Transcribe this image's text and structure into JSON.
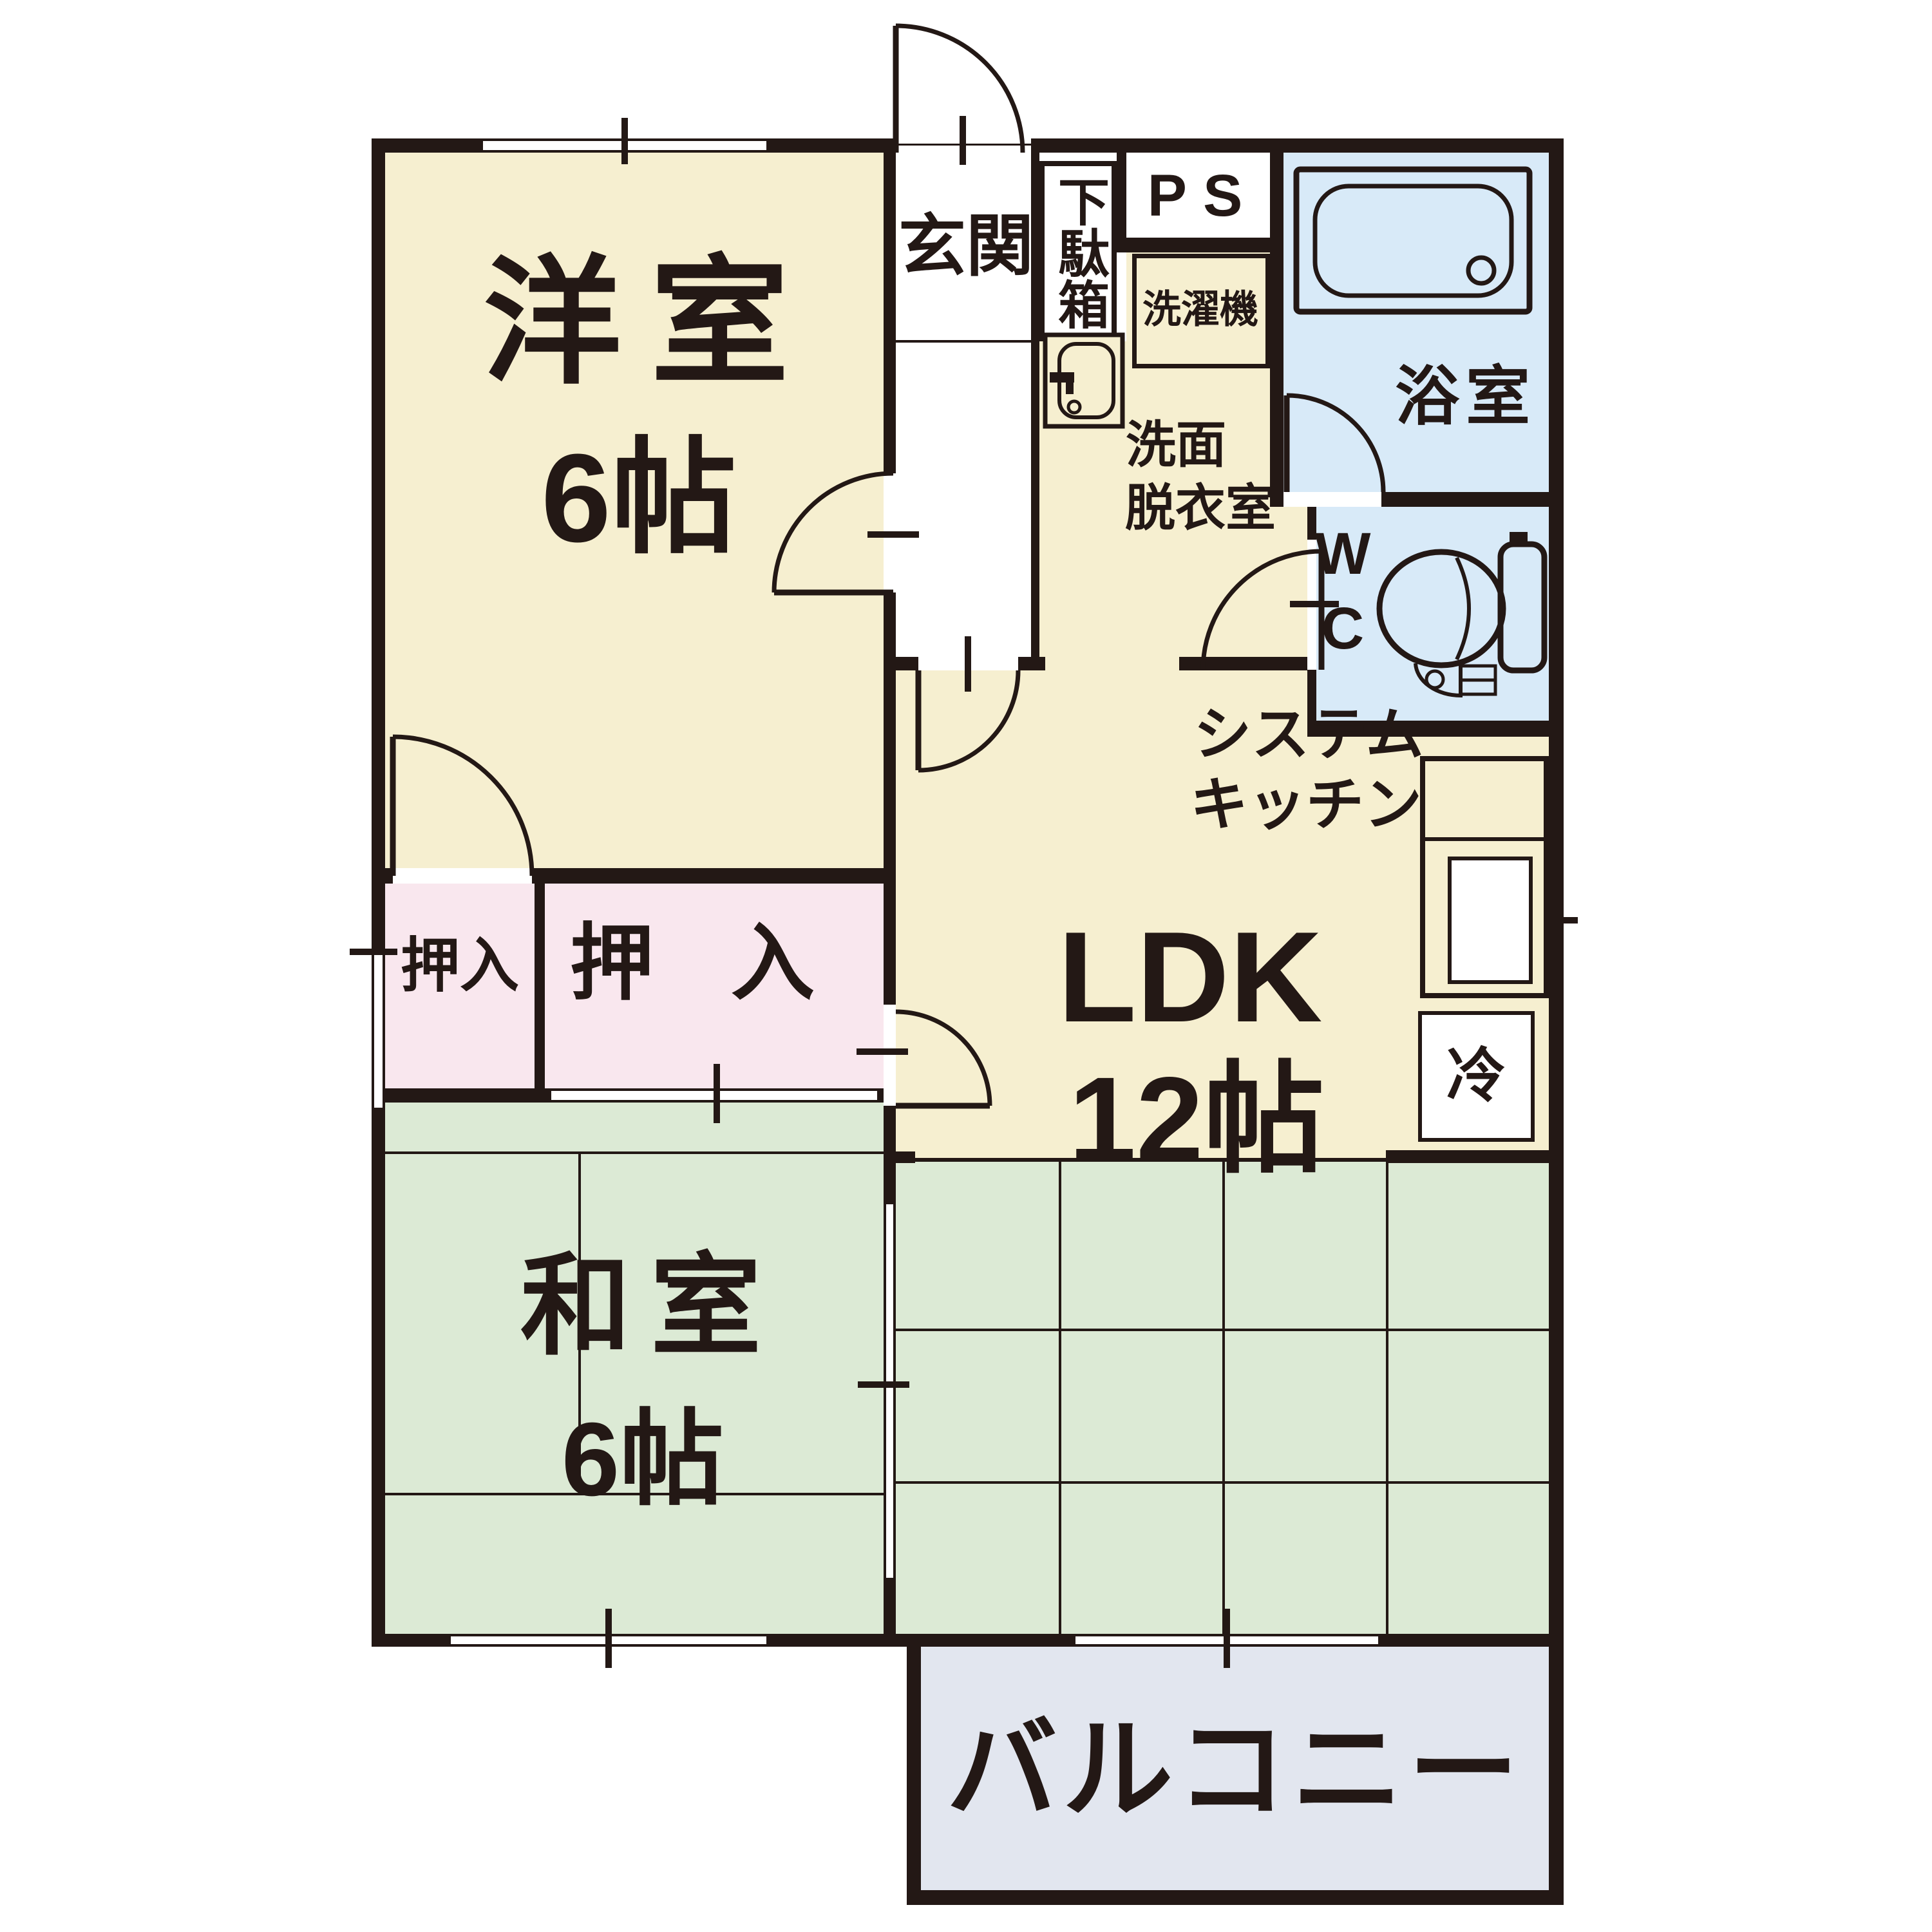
{
  "plan": {
    "rooms": {
      "yoshitsu": {
        "name": "洋室",
        "size": "6帖"
      },
      "washitsu": {
        "name": "和室",
        "size": "6帖"
      },
      "ldk": {
        "name": "LDK",
        "size": "12帖"
      },
      "genkan": {
        "name": "玄関"
      },
      "getabako": {
        "name": "下駄箱"
      },
      "ps": {
        "name": "PS"
      },
      "sentakuki": {
        "name": "洗濯機"
      },
      "yokushitsu": {
        "name": "浴室"
      },
      "senmen": {
        "line1": "洗面",
        "line2": "脱衣室"
      },
      "wc": {
        "line1": "W",
        "line2": "C"
      },
      "kitchen": {
        "line1": "システム",
        "line2": "キッチン"
      },
      "refrigerator": {
        "name": "冷"
      },
      "oshiire_small": {
        "name": "押入"
      },
      "oshiire_large": {
        "name": "押入"
      },
      "balcony": {
        "name": "バルコニー"
      }
    },
    "colors": {
      "wall": "#231815",
      "western_room": "#F6EFD0",
      "tatami": "#DCEAD5",
      "closet": "#F9E7EE",
      "bath_wc": "#D8EAF8",
      "balcony": "#E2E6EF",
      "background": "#FFFFFF"
    }
  }
}
